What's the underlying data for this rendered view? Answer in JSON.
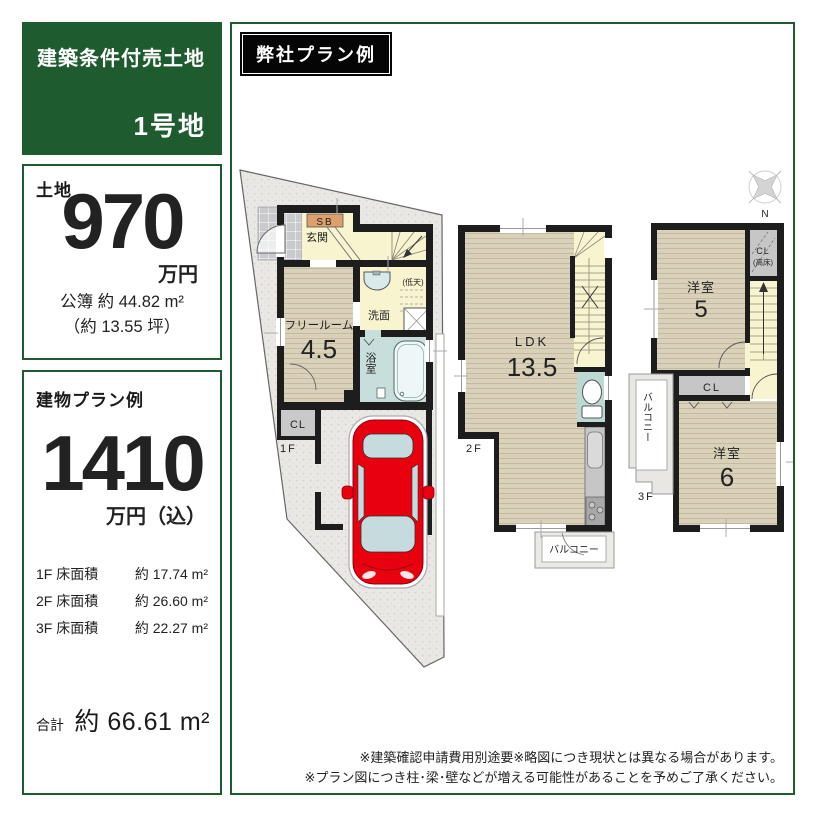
{
  "colors": {
    "brand_green": "#1e5b2e",
    "wall_black": "#1d1d1d",
    "car_red": "#e8000f"
  },
  "header": {
    "lot_type": "建築条件付売土地",
    "lot_number": "1号地"
  },
  "plan_tag": "弊社プラン例",
  "land": {
    "title": "土地",
    "price": "970",
    "price_unit": "万円",
    "area_registered": "公簿 約 44.82 m²",
    "area_tsubo": "（約 13.55 坪）"
  },
  "building": {
    "title": "建物プラン例",
    "price": "1410",
    "price_unit": "万円（込）",
    "floor_areas": [
      {
        "label": "1F 床面積",
        "value": "約 17.74 m²"
      },
      {
        "label": "2F 床面積",
        "value": "約 26.60 m²"
      },
      {
        "label": "3F 床面積",
        "value": "約 22.27 m²"
      }
    ],
    "total_label": "合計",
    "total_value": "約 66.61 m²"
  },
  "floor1": {
    "label": "1F",
    "shoe_box": "SB",
    "entrance": "玄関",
    "free_room": "フリールーム",
    "free_room_size": "4.5",
    "washroom": "洗面",
    "low_ceiling": "(低天)",
    "bathroom": "浴室",
    "closet": "CL"
  },
  "floor2": {
    "label": "2F",
    "ldk": "LDK",
    "ldk_size": "13.5",
    "balcony": "バルコニー"
  },
  "floor3": {
    "label": "3F",
    "room_a": "洋室",
    "room_a_size": "5",
    "closet_high": "CL",
    "closet_high_note": "(高床)",
    "closet": "CL",
    "room_b": "洋室",
    "room_b_size": "6",
    "balcony": "バルコニー"
  },
  "compass": {
    "north": "N"
  },
  "disclaimer": {
    "line1": "※建築確認申請費用別途要※略図につき現状とは異なる場合があります。",
    "line2": "※プラン図につき柱･梁･壁などが増える可能性があることを予めご了承ください。"
  }
}
